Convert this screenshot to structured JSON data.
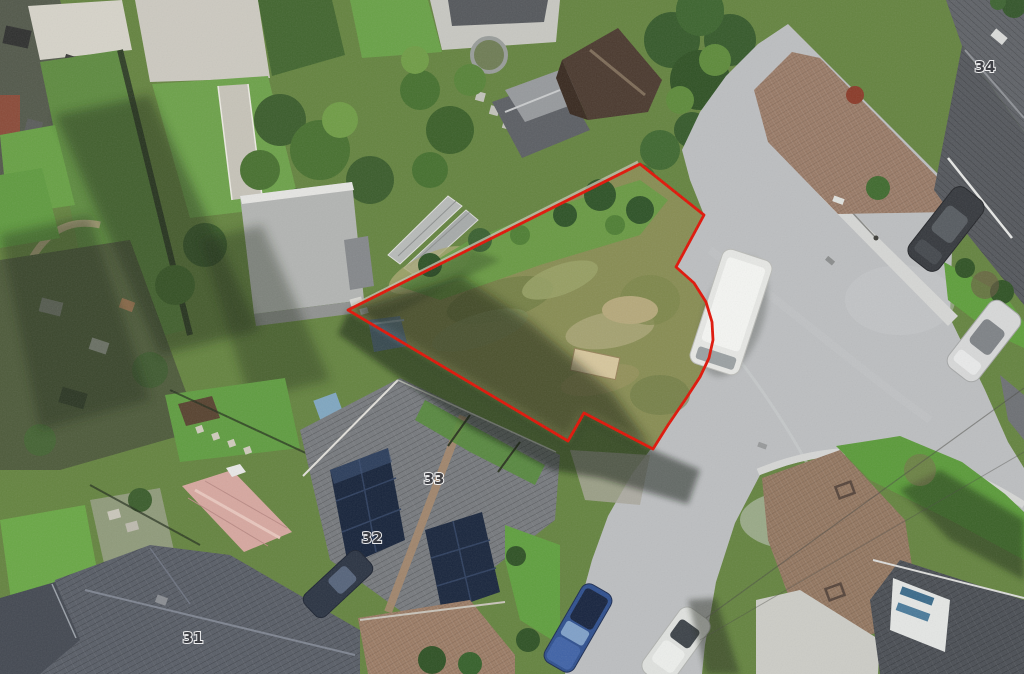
{
  "map": {
    "type": "aerial-imagery",
    "description": "Aerial photograph of a residential cul-de-sac with a vacant overgrown plot outlined by a red site boundary",
    "house_numbers": [
      {
        "label": "34"
      },
      {
        "label": "33"
      },
      {
        "label": "32"
      },
      {
        "label": "31"
      }
    ],
    "site_boundary": {
      "color": "#e01306",
      "stroke_width": 2.8,
      "points": "348,310 640,164 704,215 676,267 694,283 706,302 712,322 713,340 709,358 700,377 685,400 668,425 653,449 584,413 568,441"
    },
    "palette": {
      "boundary_red": "#e01306",
      "road_gray": "#bcbec0",
      "sidewalk": "#d5d6d4",
      "driveway_brown": "#997a66",
      "plot_scrub": "#878c52",
      "lawn_green": "#5f9c40",
      "roof_dark": "#585d66",
      "solar_navy": "#16233a",
      "shed_pink": "#d6a79f",
      "van_white": "#e6e7e4",
      "car_blue": "#2e4f8e"
    }
  }
}
